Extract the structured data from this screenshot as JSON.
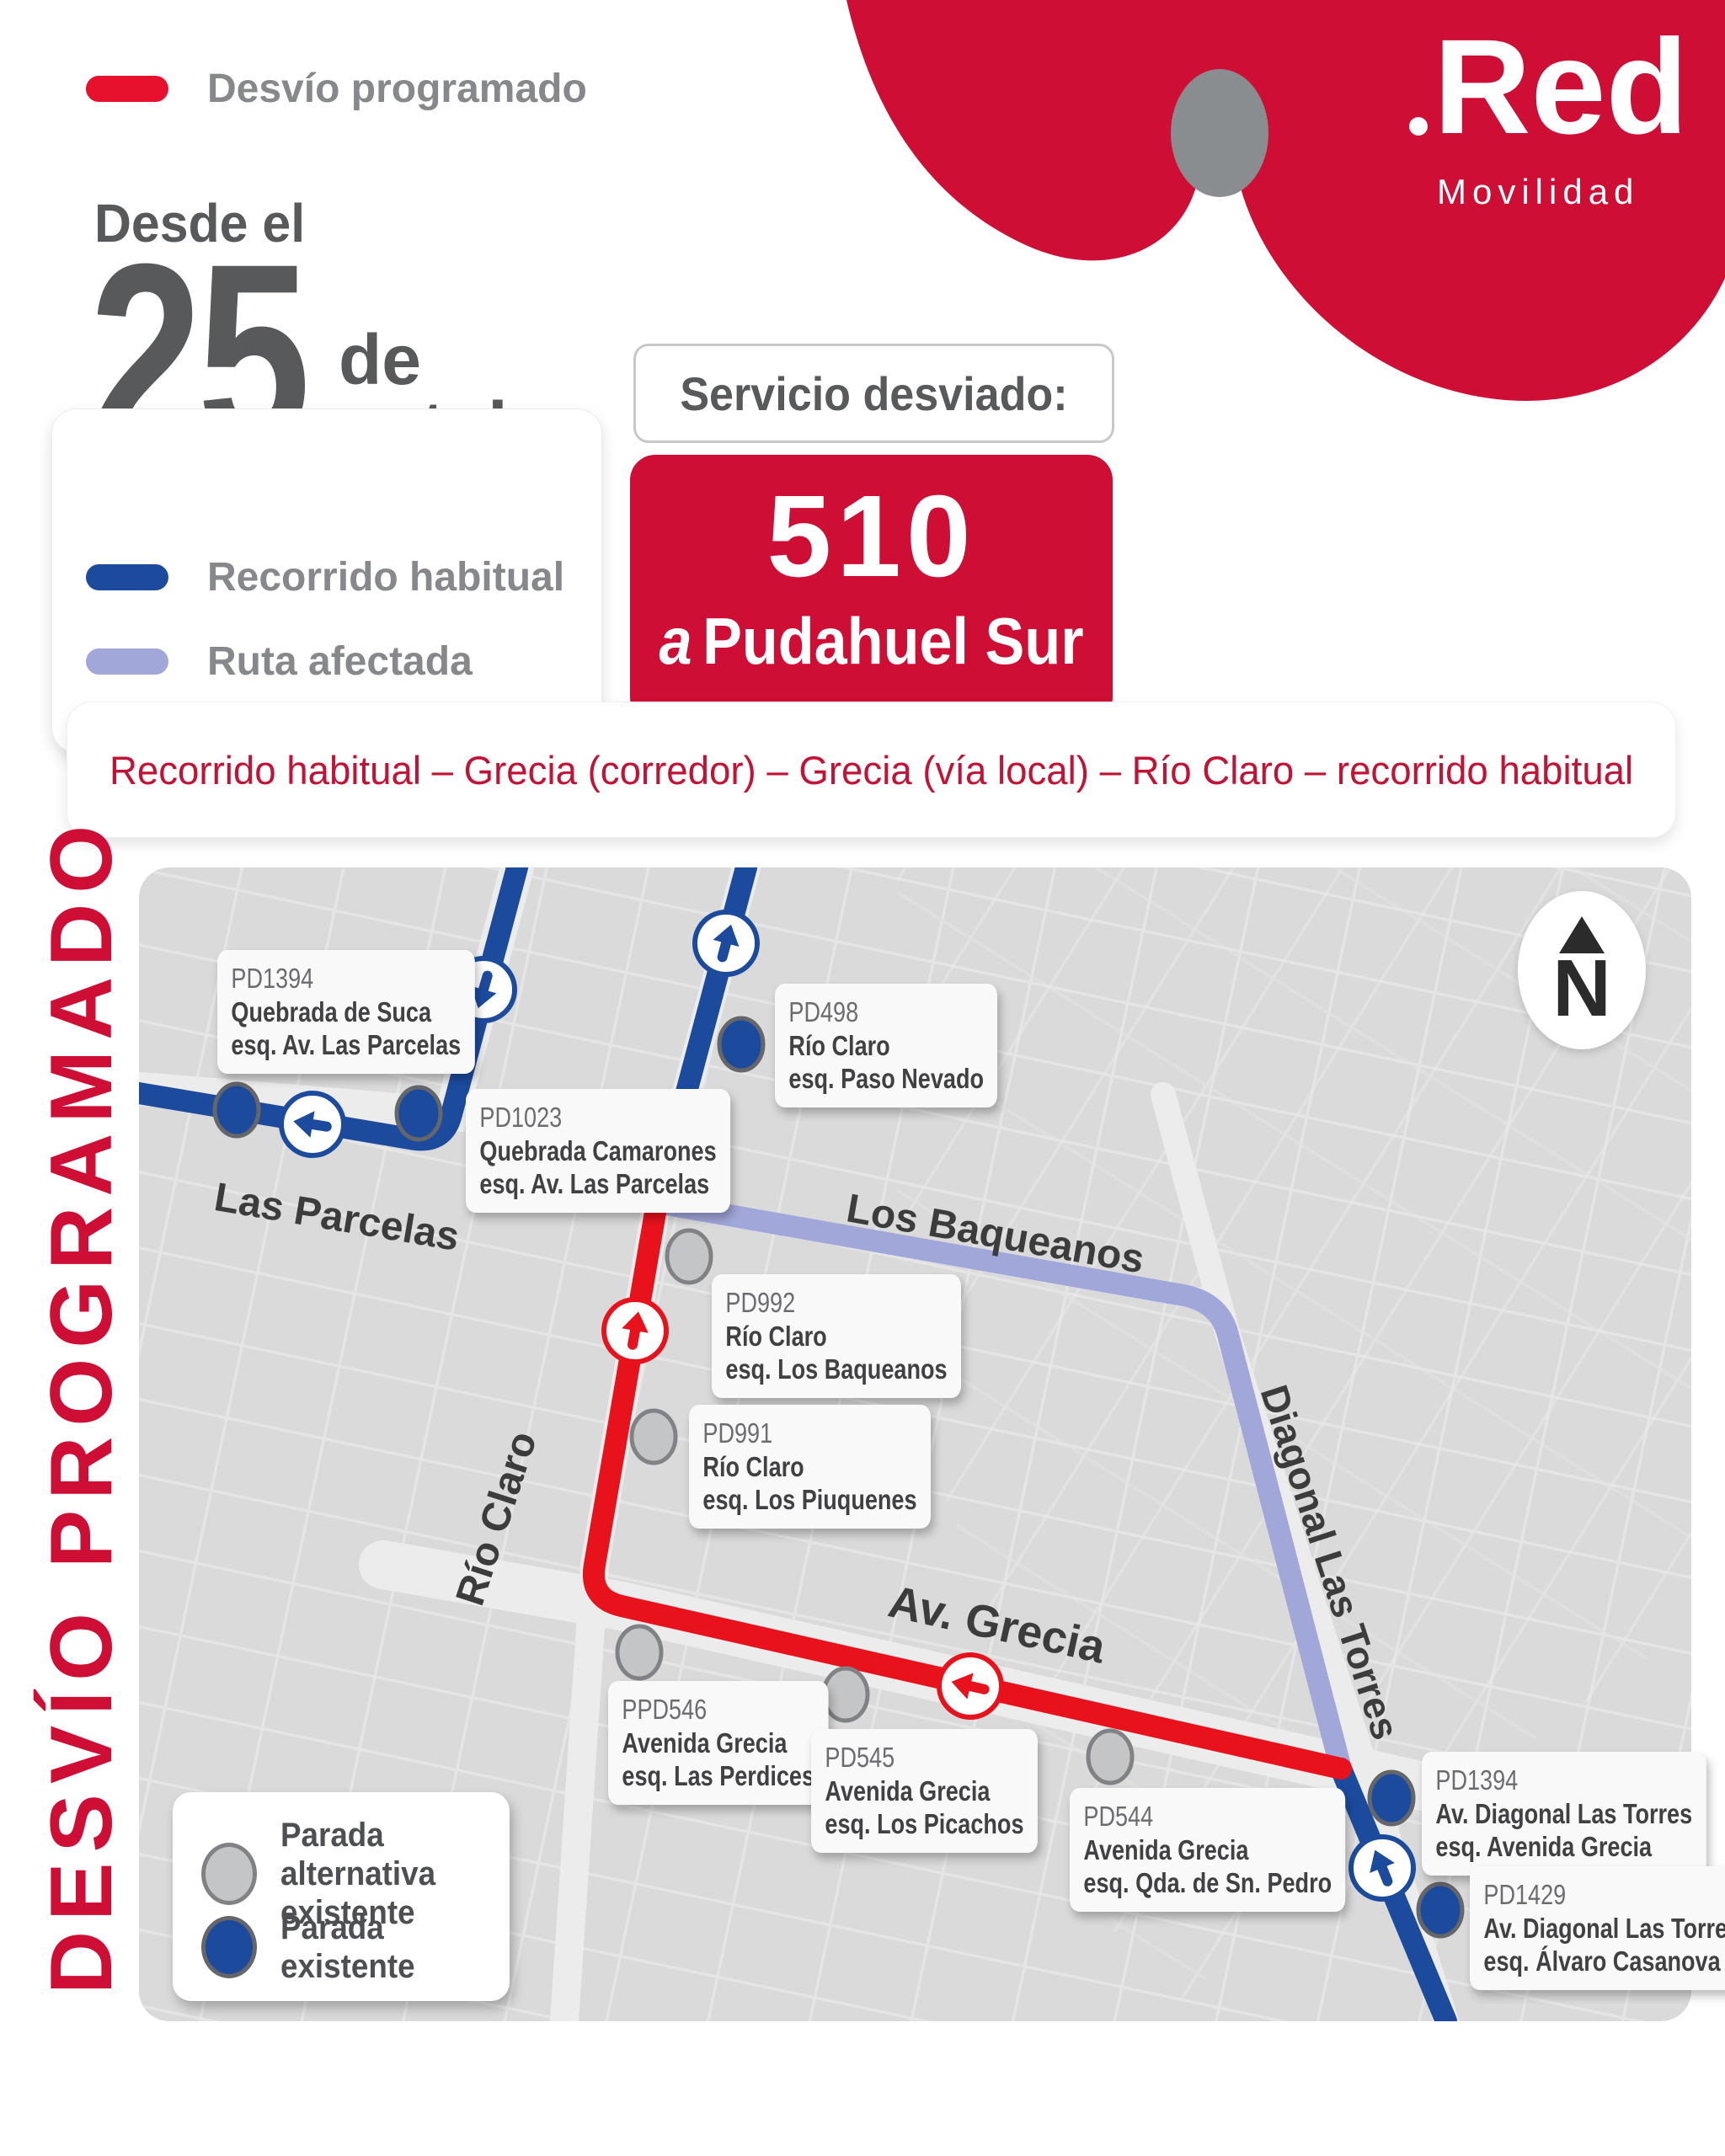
{
  "colors": {
    "brand_red": "#CF0E36",
    "route_red": "#E8121D",
    "route_blue": "#1C4B9E",
    "route_purple": "#A2A7DA",
    "strip_text_red": "#C31234",
    "gray_text": "#58595B",
    "map_bg": "#DADADB",
    "alt_stop_gray": "#C4C5C6"
  },
  "header": {
    "date": {
      "prefix": "Desde el",
      "day": "25",
      "de": "de",
      "month": "octubre"
    },
    "brand": {
      "logo": "Red",
      "sub": "Movilidad"
    },
    "service_label": "Servicio desviado:",
    "service": {
      "number": "510",
      "dest_prefix": "a",
      "dest": "Pudahuel Sur"
    }
  },
  "legend": {
    "items": [
      {
        "label": "Desvío programado",
        "color": "#E8112D"
      },
      {
        "label": "Recorrido habitual",
        "color": "#1C4B9E"
      },
      {
        "label": "Ruta afectada",
        "color": "#A2A7DA"
      }
    ]
  },
  "route_summary": "Recorrido habitual – Grecia (corredor) – Grecia (vía local) – Río Claro – recorrido habitual",
  "side_banner": "DESVÍO PROGRAMADO",
  "map": {
    "north_label": "N",
    "streets": [
      {
        "name": "Las Parcelas"
      },
      {
        "name": "Los Baqueanos"
      },
      {
        "name": "Río Claro"
      },
      {
        "name": "Av. Grecia"
      },
      {
        "name": "Diagonal Las Torres"
      }
    ],
    "stops": [
      {
        "code": "PD1394",
        "name": "Quebrada de Suca",
        "cross": "esq. Av. Las Parcelas",
        "type": "existente"
      },
      {
        "code": "PD1023",
        "name": "Quebrada Camarones",
        "cross": "esq. Av. Las Parcelas",
        "type": "existente"
      },
      {
        "code": "PD498",
        "name": "Río Claro",
        "cross": "esq. Paso Nevado",
        "type": "existente"
      },
      {
        "code": "PD992",
        "name": "Río Claro",
        "cross": "esq. Los Baqueanos",
        "type": "alternativa"
      },
      {
        "code": "PD991",
        "name": "Río Claro",
        "cross": "esq. Los Piuquenes",
        "type": "alternativa"
      },
      {
        "code": "PPD546",
        "name": "Avenida Grecia",
        "cross": "esq. Las Perdices",
        "type": "alternativa"
      },
      {
        "code": "PD545",
        "name": "Avenida Grecia",
        "cross": "esq. Los Picachos",
        "type": "alternativa"
      },
      {
        "code": "PD544",
        "name": "Avenida Grecia",
        "cross": "esq. Qda. de Sn. Pedro",
        "type": "alternativa"
      },
      {
        "code": "PD1394",
        "name": "Av. Diagonal Las Torres",
        "cross": "esq. Avenida Grecia",
        "type": "existente"
      },
      {
        "code": "PD1429",
        "name": "Av. Diagonal Las Torres",
        "cross": "esq. Álvaro Casanova",
        "type": "existente"
      }
    ],
    "legend": [
      {
        "label": "Parada alternativa existente",
        "type": "alternativa"
      },
      {
        "label": "Parada existente",
        "type": "existente"
      }
    ]
  }
}
